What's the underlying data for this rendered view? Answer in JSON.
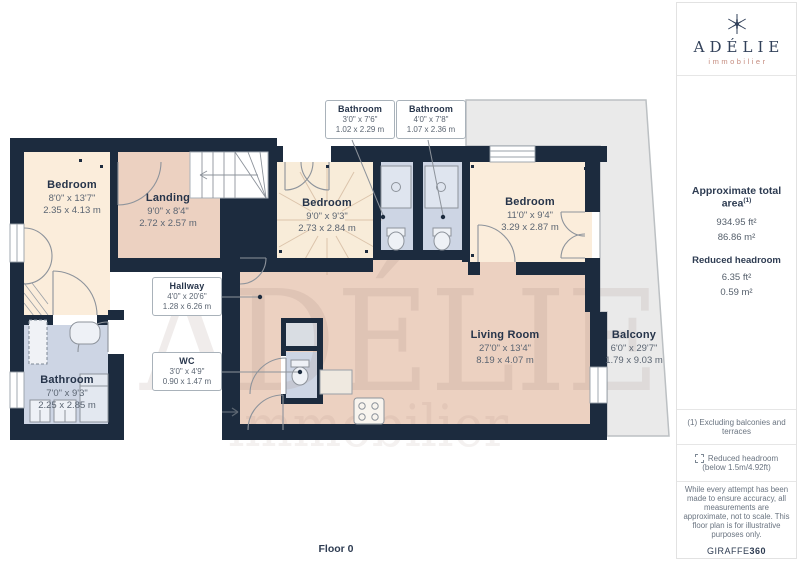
{
  "floorplan": {
    "floor_label": "Floor 0",
    "rooms": [
      {
        "name": "Bedroom",
        "dims_ft": "8'0\" x 13'7\"",
        "dims_m": "2.35 x 4.13 m"
      },
      {
        "name": "Landing",
        "dims_ft": "9'0\" x 8'4\"",
        "dims_m": "2.72 x 2.57 m"
      },
      {
        "name": "Bedroom",
        "dims_ft": "9'0\" x 9'3\"",
        "dims_m": "2.73 x 2.84 m"
      },
      {
        "name": "Bathroom",
        "dims_ft": "3'0\" x 7'6\"",
        "dims_m": "1.02 x 2.29 m"
      },
      {
        "name": "Bathroom",
        "dims_ft": "4'0\" x 7'8\"",
        "dims_m": "1.07 x 2.36 m"
      },
      {
        "name": "Bedroom",
        "dims_ft": "11'0\" x 9'4\"",
        "dims_m": "3.29 x 2.87 m"
      },
      {
        "name": "Hallway",
        "dims_ft": "4'0\" x 20'6\"",
        "dims_m": "1.28 x 6.26 m"
      },
      {
        "name": "WC",
        "dims_ft": "3'0\" x 4'9\"",
        "dims_m": "0.90 x 1.47 m"
      },
      {
        "name": "Bathroom",
        "dims_ft": "7'0\" x 9'3\"",
        "dims_m": "2.25 x 2.85 m"
      },
      {
        "name": "Living Room",
        "dims_ft": "27'0\" x 13'4\"",
        "dims_m": "8.19 x 4.07 m"
      },
      {
        "name": "Balcony",
        "dims_ft": "6'0\" x 29'7\"",
        "dims_m": "1.79 x 9.03 m"
      }
    ],
    "watermark": {
      "line1": "ADÉLIE",
      "line2": "immobilier"
    }
  },
  "sidebar": {
    "logo": {
      "name": "ADÉLIE",
      "subtitle": "immobilier"
    },
    "area": {
      "title": "Approximate total area",
      "title_sup": "(1)",
      "value_ft": "934.95 ft²",
      "value_m": "86.86 m²",
      "reduced_title": "Reduced headroom",
      "reduced_ft": "6.35 ft²",
      "reduced_m": "0.59 m²"
    },
    "note": "(1) Excluding balconies and terraces",
    "legend": {
      "label": "Reduced headroom",
      "sublabel": "(below 1.5m/4.92ft)"
    },
    "disclaimer": "While every attempt has been made to ensure accuracy, all measurements are approximate, not to scale. This floor plan is for illustrative purposes only.",
    "brand": {
      "name": "GIRAFFE",
      "suffix": "360"
    }
  },
  "colors": {
    "wall": "#1c2b3e",
    "room_cream": "#fbeddb",
    "room_pink": "#ecd1c1",
    "room_blue": "#cdd5e4",
    "balcony_gray": "#eaeaea",
    "logo_accent": "#c58d80"
  }
}
